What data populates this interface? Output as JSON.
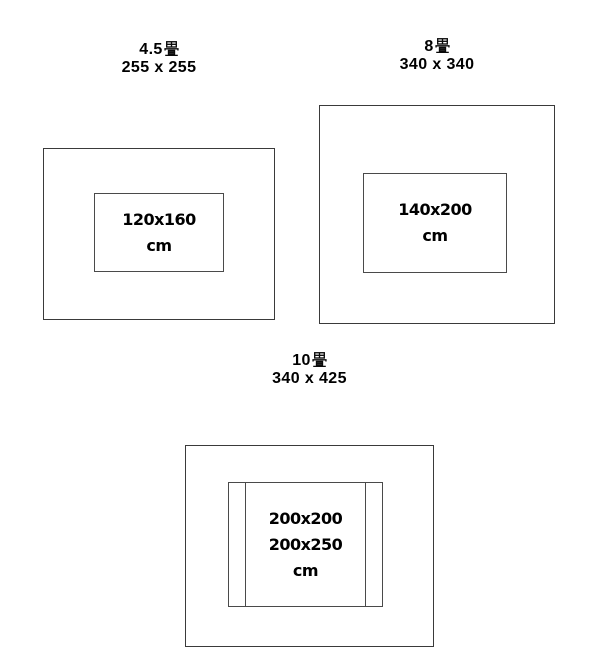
{
  "colors": {
    "background": "#ffffff",
    "room_line": "#3a3a3a",
    "rug_line": "#4a4a4a",
    "text": "#000000"
  },
  "diagrams": [
    {
      "tatami_count": "4.5",
      "tatami_unit": "畳",
      "room_size_cm": "255 x 255",
      "rug_lines": [
        "120x160",
        "cm"
      ]
    },
    {
      "tatami_count": "8",
      "tatami_unit": "畳",
      "room_size_cm": "340 x 340",
      "rug_lines": [
        "140x200",
        "cm"
      ]
    },
    {
      "tatami_count": "10",
      "tatami_unit": "畳",
      "room_size_cm": "340 x 425",
      "rug_lines": [
        "200x200",
        "200x250",
        "cm"
      ]
    }
  ]
}
